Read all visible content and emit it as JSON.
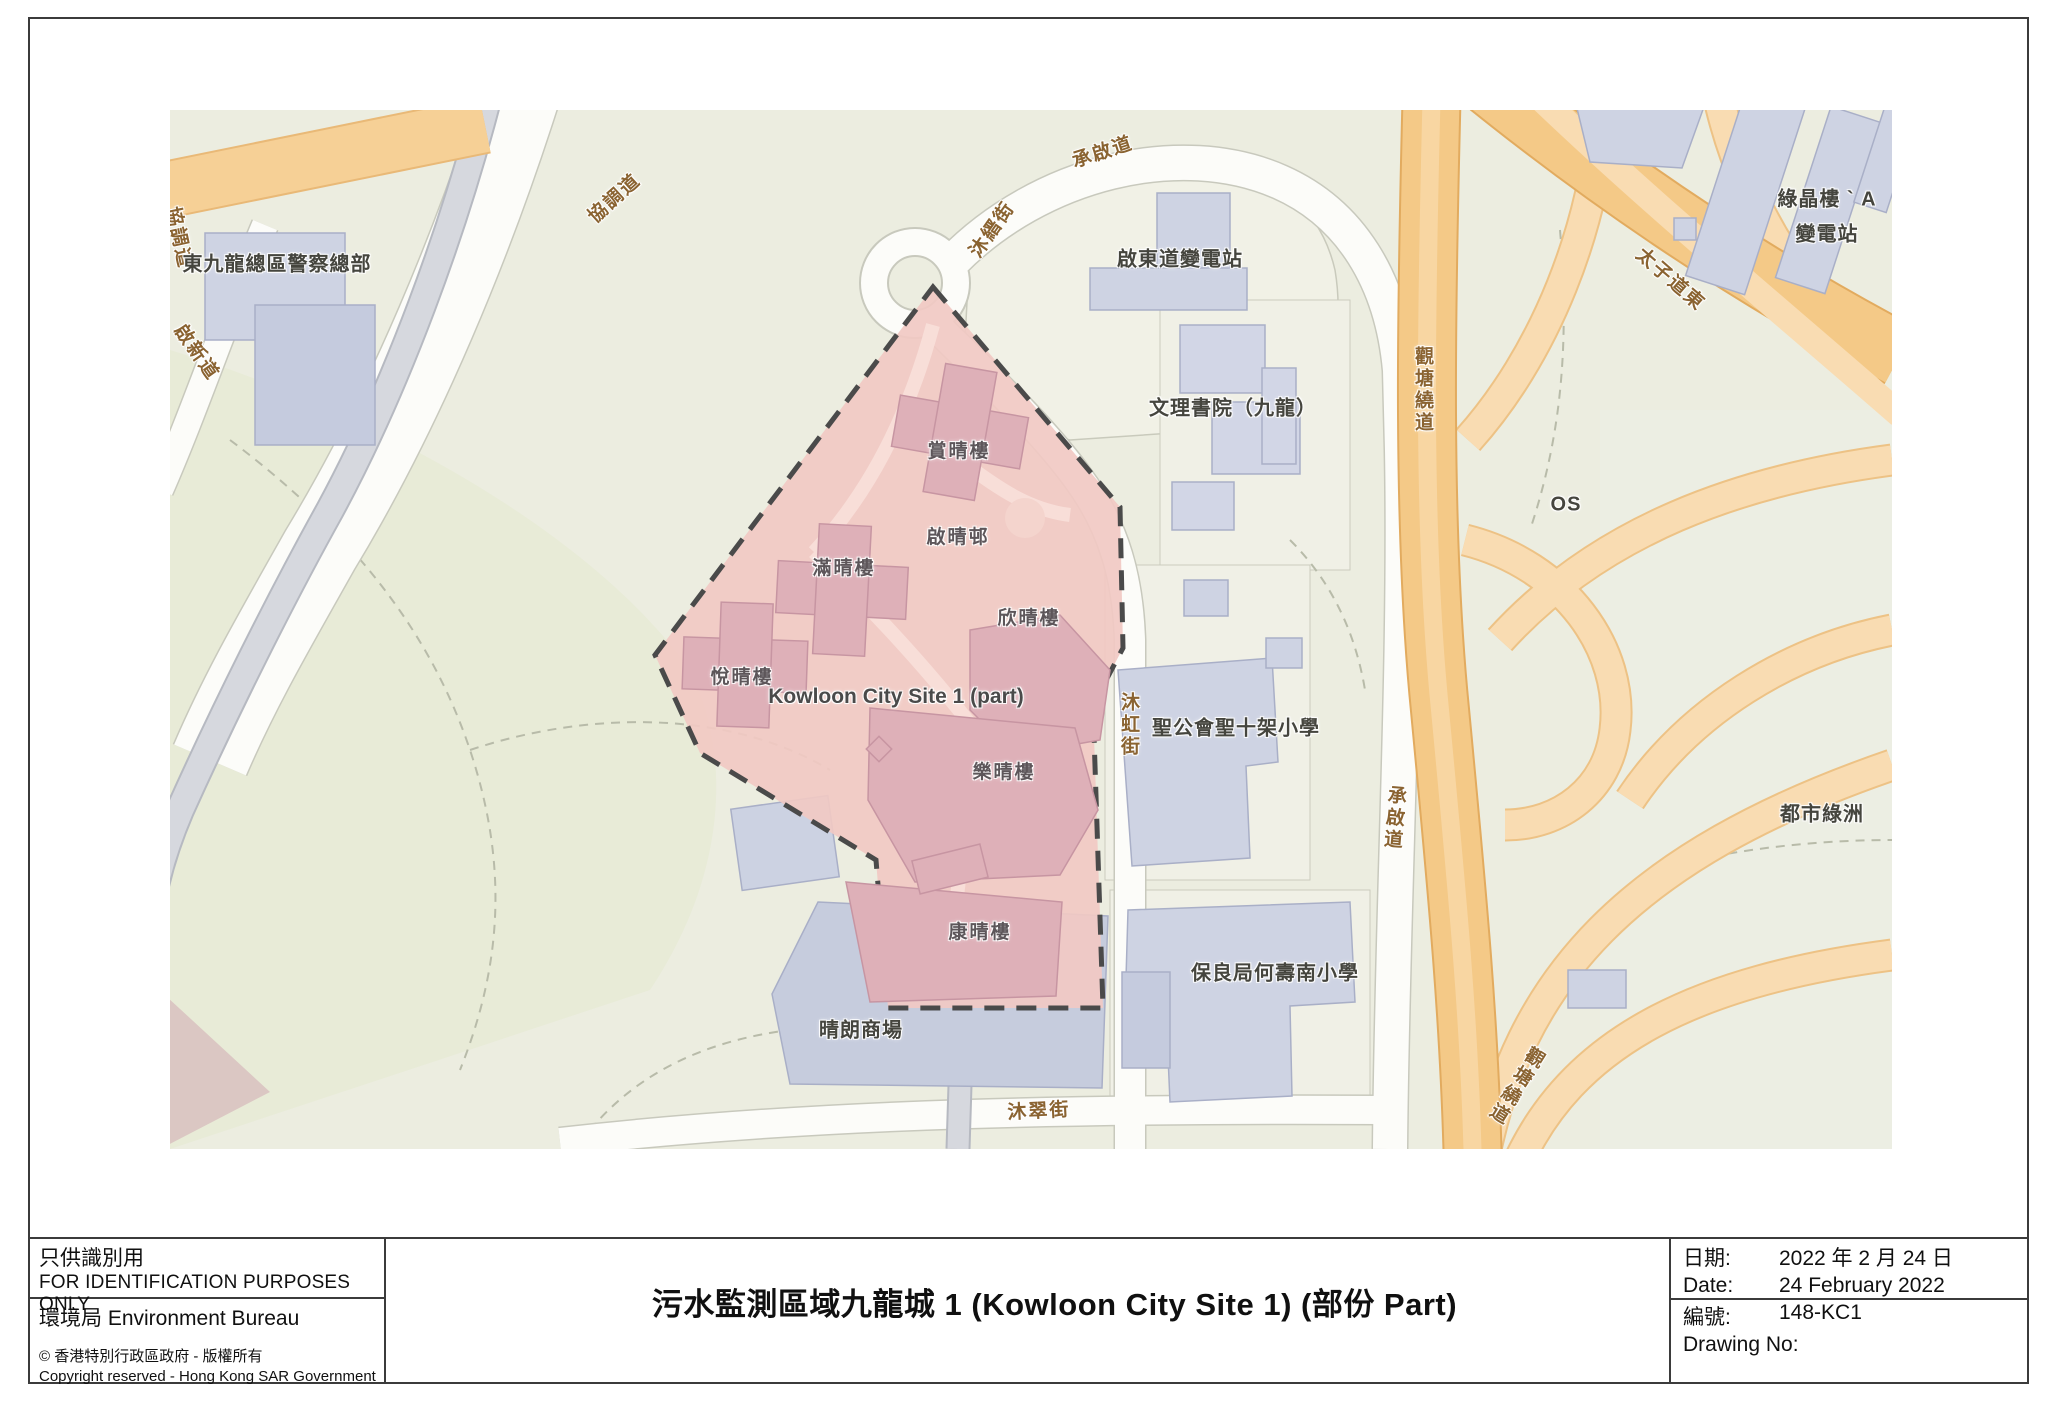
{
  "map": {
    "colors": {
      "land": "#ECEDE0",
      "green_open_space": "#E8EBD7",
      "road_white": "#FCFCF9",
      "road_gray": "#D6D8DE",
      "highway_orange": "#F4C987",
      "highway_ramp": "#F9DCB2",
      "building_gray": "#CED3E3",
      "site_fill": "#F1C9C3",
      "site_building": "#DEB0B8",
      "site_boundary": "#4A4A4A",
      "street_label": "#8A6331",
      "place_label": "#45453E"
    },
    "street_labels": [
      {
        "text": "協調道"
      },
      {
        "text": "協調道"
      },
      {
        "text": "啟新道"
      },
      {
        "text": "承啟道"
      },
      {
        "text": "沐縉街"
      },
      {
        "text": "沐虹街"
      },
      {
        "text": "承啟道"
      },
      {
        "text": "沐翠街"
      },
      {
        "text": "太子道東"
      },
      {
        "text": "觀塘繞道"
      },
      {
        "text": "觀塘繞道"
      }
    ],
    "place_labels": [
      {
        "text": "東九龍總區警察總部"
      },
      {
        "text": "啟東道變電站"
      },
      {
        "text": "文理書院（九龍）"
      },
      {
        "text": "綠晶樓 ` A"
      },
      {
        "text": "變電站"
      },
      {
        "text": "OS"
      },
      {
        "text": "聖公會聖十架小學"
      },
      {
        "text": "保良局何壽南小學"
      },
      {
        "text": "都市綠洲"
      },
      {
        "text": "晴朗商場"
      }
    ],
    "site": {
      "name_en": "Kowloon City Site 1 (part)",
      "estate_labels": [
        {
          "text": "賞晴樓"
        },
        {
          "text": "啟晴邨"
        },
        {
          "text": "滿晴樓"
        },
        {
          "text": "欣晴樓"
        },
        {
          "text": "悅晴樓"
        },
        {
          "text": "樂晴樓"
        },
        {
          "text": "康晴樓"
        }
      ]
    }
  },
  "footer": {
    "left": {
      "id_zh": "只供識別用",
      "id_en": "FOR IDENTIFICATION PURPOSES ONLY",
      "bureau": "環境局  Environment Bureau",
      "copyright_zh": "©  香港特別行政區政府  -  版權所有",
      "copyright_en": "Copyright reserved - Hong Kong SAR Government"
    },
    "title": "污水監測區域九龍城 1 (Kowloon City Site 1) (部份 Part)",
    "right": {
      "date_label_zh": "日期:",
      "date_value_zh": "2022 年 2 月 24 日",
      "date_label_en": "Date:",
      "date_value_en": "24 February 2022",
      "no_label_zh": "編號:",
      "no_value": "148-KC1",
      "no_label_en": "Drawing No:"
    }
  }
}
